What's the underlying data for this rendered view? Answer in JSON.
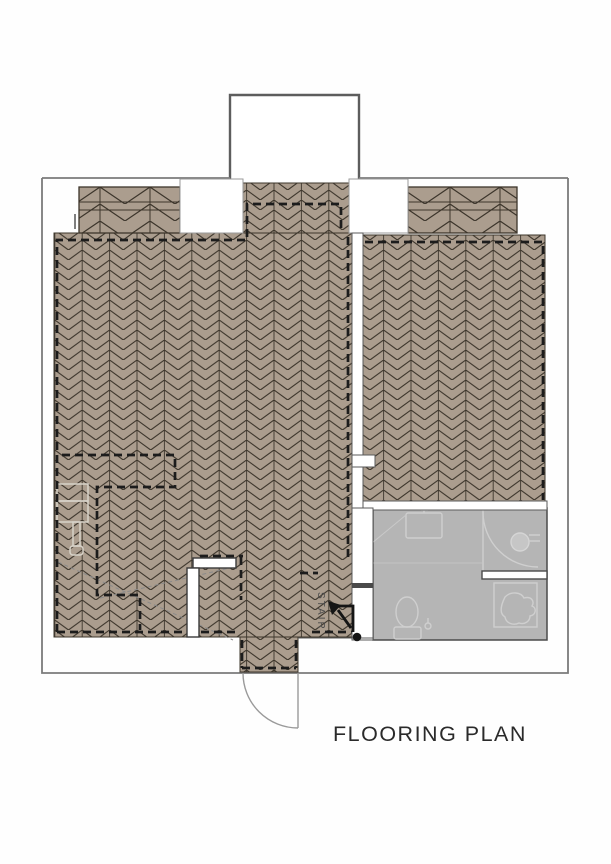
{
  "document": {
    "title": "FLOORING PLAN",
    "stair_label": "STAIR"
  },
  "colors": {
    "page_background": "#fefefe",
    "wood_floor": "#ab9d8e",
    "wood_pattern_line": "#3c352b",
    "bathroom_tile_gray": "#b5b5b5",
    "fixture_outline": "#cfcfcf",
    "ghost_furniture_outline": "#d8d3c9",
    "dashed_boundary": "#1c1c1c",
    "building_outline": "#7b7b7b",
    "bay_window_outline": "#5d5d5d",
    "door_swing": "#9a9a9a",
    "stair_arrow": "#151515",
    "title_text": "#2a2a2a"
  }
}
